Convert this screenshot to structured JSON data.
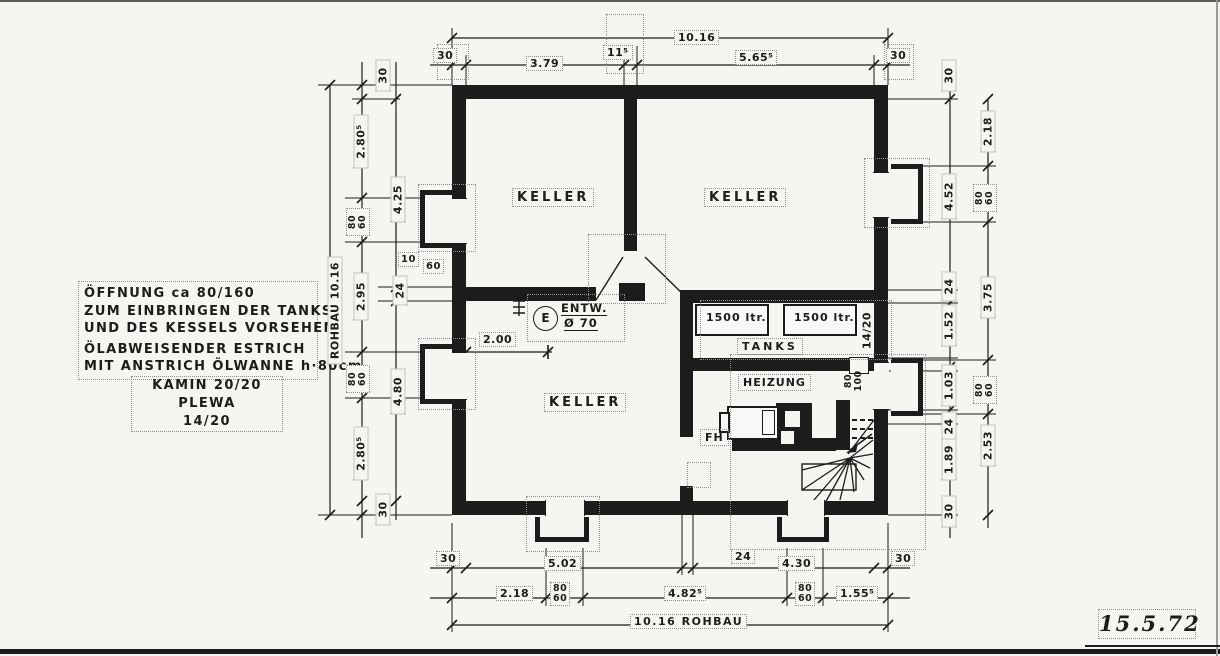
{
  "sheet": {
    "date": "15.5.72"
  },
  "notes": {
    "line1": "ÖFFNUNG ca 80/160",
    "line2": "ZUM EINBRINGEN DER TANKS",
    "line3": "UND DES KESSELS VORSEHEN",
    "line4": "ÖLABWEISENDER ESTRICH",
    "line5": "MIT ANSTRICH ÖLWANNE h·80cm",
    "kamin1": "KAMIN 20/20 PLEWA",
    "kamin2": "14/20"
  },
  "rooms": {
    "keller_tl": "KELLER",
    "keller_tr": "KELLER",
    "keller_bl": "KELLER",
    "tanks": "TANKS",
    "heizung": "HEIZUNG",
    "fh": "FH",
    "tank_left": "1500 ltr.",
    "tank_right": "1500 ltr.",
    "drain_symbol": "E",
    "drain_label": "ENTW.",
    "drain_dia": "Ø 70",
    "flue": "14/20",
    "flue_opening": "80\n100"
  },
  "dims": {
    "top_total": "10.16",
    "bottom_total": "10.16 ROHBAU",
    "left_total": "ROHBAU 10.16",
    "keller_width": "2.00",
    "top": [
      "30",
      "3.79",
      "11⁵",
      "5.65⁵",
      "30"
    ],
    "left_a": [
      "30",
      "2.80⁵",
      "80\n60",
      "2.95",
      "80\n60",
      "2.80⁵",
      "30"
    ],
    "left_b": [
      "4.25",
      "24",
      "4.80"
    ],
    "wall_detail": [
      "10",
      "60"
    ],
    "right_a": [
      "30",
      "4.52",
      "24",
      "1.52",
      "1.03",
      "24",
      "1.89",
      "30"
    ],
    "right_b": [
      "2.18",
      "80\n60",
      "3.75",
      "80\n60",
      "2.53"
    ],
    "bottom_a": [
      "30",
      "5.02",
      "24",
      "4.30",
      "30"
    ],
    "bottom_b": [
      "2.18",
      "80\n60",
      "4.82⁵",
      "80\n60",
      "1.55⁵"
    ]
  }
}
